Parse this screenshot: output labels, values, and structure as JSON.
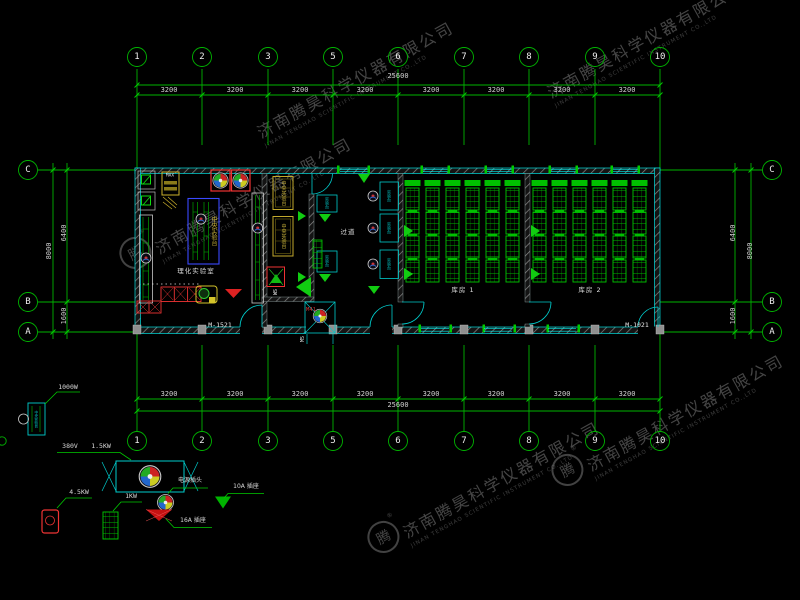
{
  "watermark": {
    "company_cn": "济南腾昊科学仪器有限公司",
    "company_en": "JINAN TENGHAO SCIENTIFIC INSTRUMENT CO.,LTD",
    "logo_char": "腾",
    "registered_mark": "®"
  },
  "grid": {
    "axes_horizontal": [
      "1",
      "2",
      "3",
      "5",
      "6",
      "7",
      "8",
      "9",
      "10"
    ],
    "axes_vertical": [
      "C",
      "B",
      "A"
    ],
    "span_dims": [
      "3200",
      "3200",
      "3200",
      "3200",
      "3200",
      "3200",
      "3200",
      "3200"
    ],
    "total_dim": "25600",
    "side_dims": {
      "upper": "6400",
      "lower": "1600",
      "overall": "8000"
    }
  },
  "plan": {
    "rooms": {
      "lab": "理化实验室",
      "corridor": "过道",
      "storage1": "库房 1",
      "storage2": "库房 2"
    },
    "labels": {
      "central_bench": "中央实验台",
      "side_bench": "实验台",
      "cabinet_tag": "MAX",
      "door_left": "M-1521",
      "door_right": "M-1021",
      "door_small": "M5",
      "ws_tag": "WS",
      "entry_tag": "M41"
    }
  },
  "legend": {
    "items": [
      {
        "name": "bench-unit",
        "label": "1000W"
      },
      {
        "name": "ventilation-unit",
        "volt": "380V",
        "label": "1.5KW"
      },
      {
        "name": "heater-unit",
        "label": "4.5KW"
      },
      {
        "name": "rack-unit",
        "label": "1KW"
      },
      {
        "name": "power-plug",
        "label": "电源插头"
      },
      {
        "name": "socket-16a",
        "label": "16A 插座"
      },
      {
        "name": "socket-10a",
        "label": "10A 插座"
      }
    ]
  }
}
